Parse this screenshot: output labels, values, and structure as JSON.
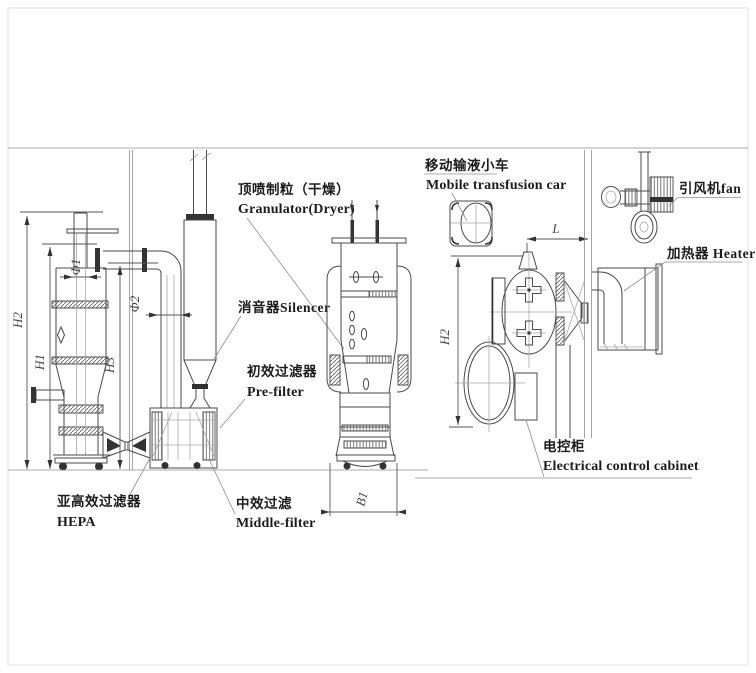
{
  "labels": {
    "granulator_zh": "顶喷制粒（干燥）",
    "granulator_en": "Granulator(Dryer)",
    "silencer": "消音器Silencer",
    "prefilter_zh": "初效过滤器",
    "prefilter_en": "Pre-filter",
    "hepa_zh": "亚高效过滤器",
    "hepa_en": "HEPA",
    "middlefilter_zh": "中效过滤",
    "middlefilter_en": "Middle-filter",
    "car_zh": "移动输液小车",
    "car_en": "Mobile transfusion car",
    "cabinet_zh": "电控柜",
    "cabinet_en": "Electrical control cabinet",
    "fan": "引风机fan",
    "heater": "加热器 Heater"
  },
  "dimensions": {
    "h1": "H1",
    "h2": "H2",
    "h3": "H3",
    "phi1": "Φ1",
    "phi2": "Φ2",
    "b1": "B1",
    "l": "L",
    "h2_plan": "H2"
  },
  "colors": {
    "line": "#4a4a4a",
    "faint": "#8f8f8f",
    "text": "#1c1c1c",
    "background": "#ffffff"
  }
}
